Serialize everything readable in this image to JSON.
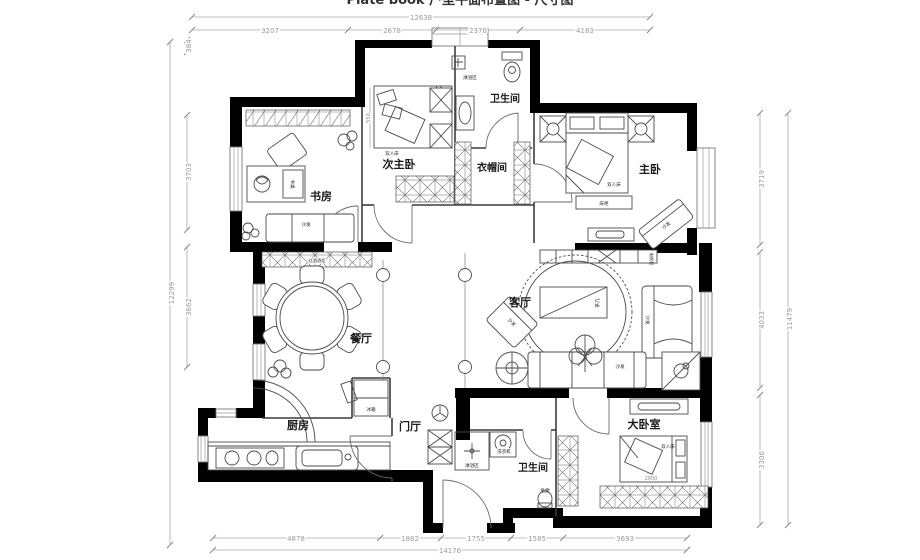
{
  "meta": {
    "clipped_title": "Plate book 户型平面布置图 - 尺寸图"
  },
  "rooms": {
    "study": "书房",
    "second_master": "次主卧",
    "bath_top": "卫生间",
    "cloakroom": "衣帽间",
    "master": "主卧",
    "living": "客厅",
    "dining": "餐厅",
    "kitchen": "厨房",
    "foyer": "门厅",
    "bath_bottom": "卫生间",
    "big_bedroom": "大卧室"
  },
  "furniture": {
    "double_bed": "双人床",
    "sofa": "沙发",
    "bed_bench": "床柜",
    "tea_table": "茶几",
    "fridge": "冰箱",
    "washer": "洗衣机",
    "shower": "淋浴区",
    "toilet_seat": "坐便",
    "wine_cabinet": "红酒酒柜",
    "desk": "书桌",
    "tv_cabinet": "电视柜"
  },
  "dimensions": {
    "top": {
      "total": "12638",
      "segments": [
        "3207",
        "2678",
        "2376",
        "4183"
      ]
    },
    "left": {
      "total": "12299",
      "segments": [
        "384",
        "3703",
        "3662"
      ]
    },
    "right": {
      "total": "11479",
      "segments": [
        "3719",
        "4033",
        "3306"
      ]
    },
    "bottom": {
      "total": "14176",
      "segments": [
        "4878",
        "1882",
        "1755",
        "1585",
        "3693"
      ]
    },
    "interior": [
      "550",
      "2000"
    ]
  },
  "colors": {
    "wall": "#000000",
    "dim_line": "#9a9a9a",
    "partition": "#3c3c3c",
    "window": "#7b7b7b"
  }
}
